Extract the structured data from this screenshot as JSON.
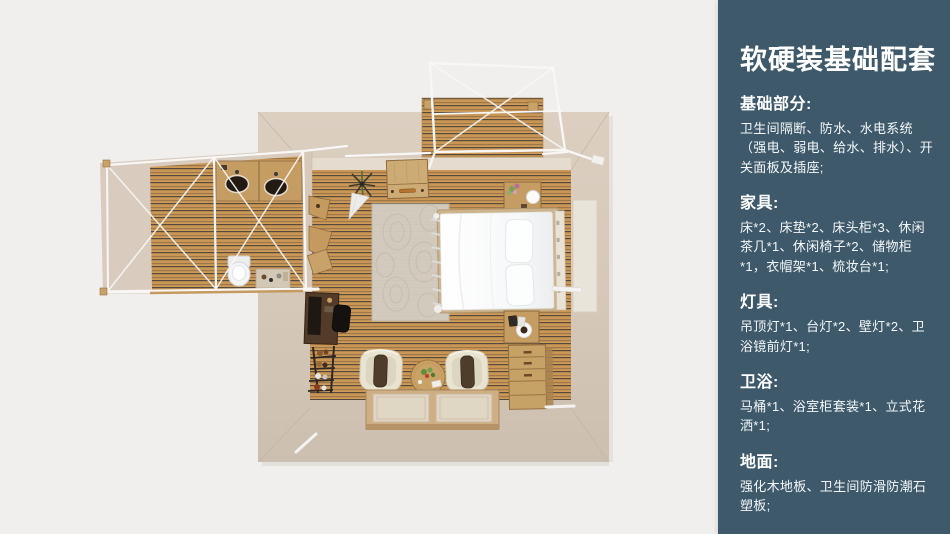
{
  "sidebar": {
    "bg_color": "#3d596a",
    "text_color": "#ffffff",
    "title": "软硬装基础配套",
    "sections": [
      {
        "heading": "基础部分:",
        "body": "卫生间隔断、防水、水电系统（强电、弱电、给水、排水）、开关面板及插座;"
      },
      {
        "heading": "家具:",
        "body": "床*2、床垫*2、床头柜*3、休闲茶几*1、休闲椅子*2、储物柜*1，衣帽架*1、梳妆台*1;"
      },
      {
        "heading": "灯具:",
        "body": "吊顶灯*1、台灯*2、壁灯*2、卫浴镜前灯*1;"
      },
      {
        "heading": "卫浴:",
        "body": "马桶*1、浴室柜套装*1、立式花洒*1;"
      },
      {
        "heading": "地面:",
        "body": "强化木地板、卫生间防滑防潮石塑板;"
      }
    ]
  },
  "floorplan": {
    "canvas_bg": "#f0efed",
    "wall_beige": "#d7cabb",
    "wall_beige_dark": "#cec0b0",
    "wood_light": "#c99653",
    "wood_dark": "#564a3e",
    "frame_white": "#f8f7f5",
    "bed_white": "#f7f8f9",
    "rug_color": "#d3ccc0"
  }
}
